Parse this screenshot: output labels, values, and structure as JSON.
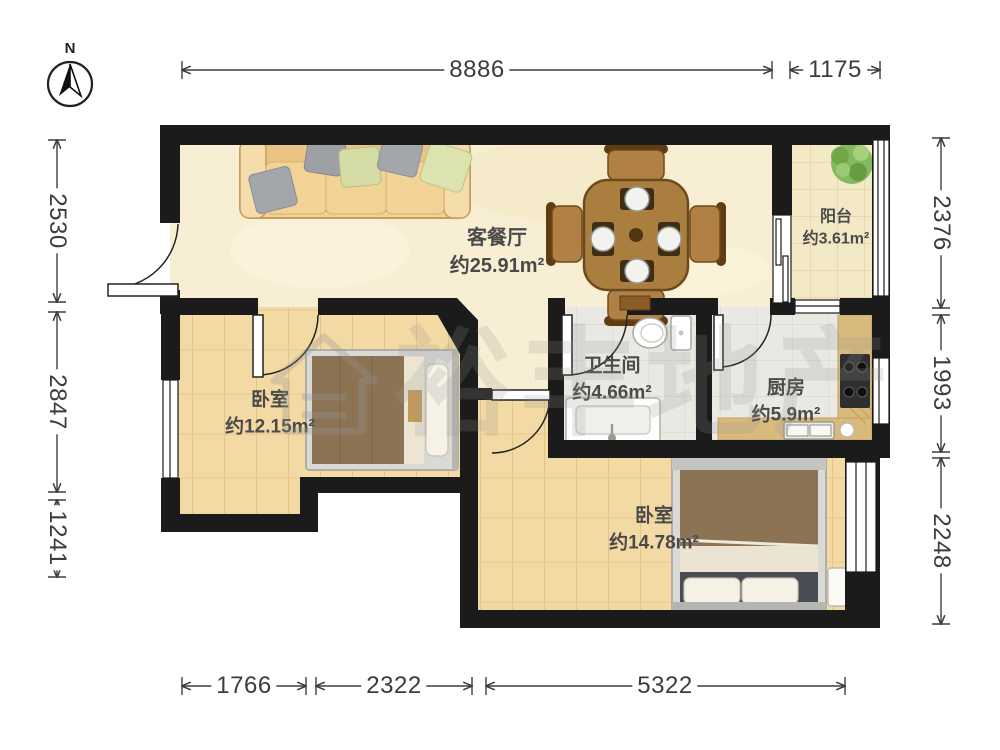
{
  "compass": {
    "label": "N"
  },
  "rooms": {
    "living": {
      "name": "客餐厅",
      "area": "约25.91m²"
    },
    "balcony": {
      "name": "阳台",
      "area": "约3.61m²"
    },
    "bedroom1": {
      "name": "卧室",
      "area": "约12.15m²"
    },
    "bathroom": {
      "name": "卫生间",
      "area": "约4.66m²"
    },
    "kitchen": {
      "name": "厨房",
      "area": "约5.9m²"
    },
    "bedroom2": {
      "name": "卧室",
      "area": "约14.78m²"
    }
  },
  "dimensions": {
    "top": [
      "8886",
      "1175"
    ],
    "left": [
      "2530",
      "2847",
      "1241"
    ],
    "right": [
      "2376",
      "1993",
      "2248"
    ],
    "bottom": [
      "1766",
      "2322",
      "5322"
    ]
  },
  "watermark": {
    "text": "裕丰地产"
  },
  "colors": {
    "wall": "#1b1b1b",
    "living_floor": "#f8eed3",
    "wood_floor": "#f2d8a1",
    "tile_floor": "#e9e8e3",
    "balcony_floor": "#f4e9c7",
    "sofa": "#f1d194",
    "table_wood": "#a97e3f",
    "blanket": "#8b7354"
  }
}
